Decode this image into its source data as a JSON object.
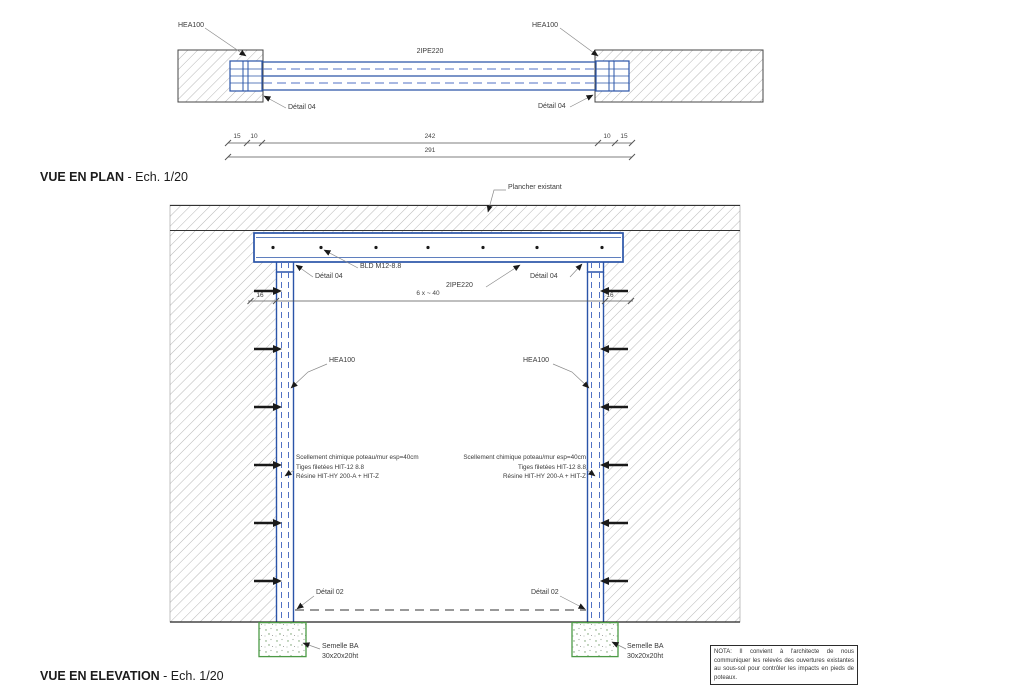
{
  "plan": {
    "title": "VUE EN PLAN",
    "scale_suffix": " - Ech. 1/20",
    "hea_left": "HEA100",
    "hea_right": "HEA100",
    "beam_label": "2IPE220",
    "detail_left": "Détail 04",
    "detail_right": "Détail 04",
    "dims": {
      "a": "15",
      "b": "10",
      "c": "242",
      "d": "10",
      "e": "15",
      "total": "291"
    }
  },
  "elevation": {
    "title": "VUE EN ELEVATION",
    "scale_suffix": " - Ech. 1/20",
    "floor_label": "Plancher existant",
    "bolt_label": "BLD M12-8.8",
    "detail04_left": "Détail 04",
    "detail04_right": "Détail 04",
    "beam_label": "2IPE220",
    "embed_left": "16",
    "embed_right": "16",
    "bolt_spacing": "6 x ~ 40",
    "hea_left": "HEA100",
    "hea_right": "HEA100",
    "anchor_note_left": {
      "l1": "Scellement chimique poteau/mur esp=40cm",
      "l2": "Tiges filetées HIT-12 8.8",
      "l3": "Résine HIT-HY 200-A + HIT-Z"
    },
    "anchor_note_right": {
      "l1": "Scellement chimique poteau/mur esp=40cm",
      "l2": "Tiges filetées HIT-12 8.8",
      "l3": "Résine HIT-HY 200-A + HIT-Z"
    },
    "detail02_left": "Détail 02",
    "detail02_right": "Détail 02",
    "footing_left": {
      "l1": "Semelle BA",
      "l2": "30x20x20ht"
    },
    "footing_right": {
      "l1": "Semelle BA",
      "l2": "30x20x20ht"
    }
  },
  "nota": "NOTA: Il convient à l'architecte de nous communiquer les relevés des ouvertures existantes au sous-sol pour contrôler les impacts en pieds de poteaux.",
  "colors": {
    "steel_blue": "#2a54a8",
    "steel_blue_light": "#5272c4",
    "hatch_gray": "#b7b7b7",
    "footing_green": "#4c9a45",
    "anchor_black": "#1a1a1a",
    "text_gray": "#3a3a3a"
  }
}
